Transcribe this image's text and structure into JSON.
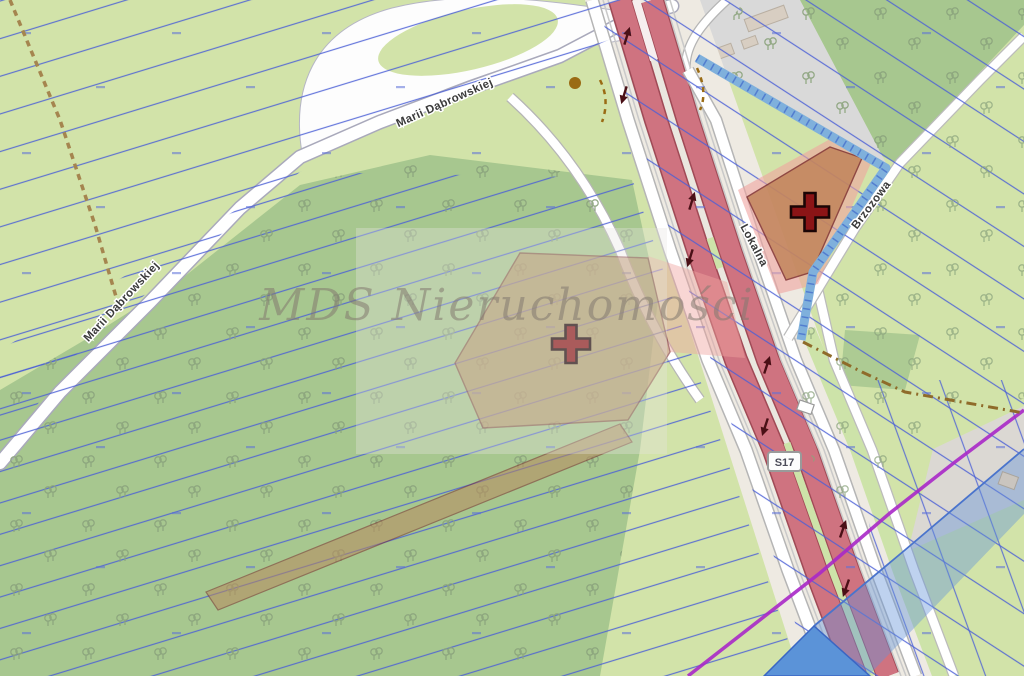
{
  "map": {
    "kind": "cadastral-property-map",
    "watermark_text": "MDS Nieruchomości",
    "labels": {
      "road_upper": "Marii Dąbrowskiej",
      "road_lower": "Marii Dąbrowskiej",
      "service_road": "Lokalna",
      "side_street": "Brzozowa",
      "route_shield": "S17"
    },
    "markers": {
      "count": 2,
      "color": "#8b1416"
    },
    "colors": {
      "field": "#d2e3a9",
      "forest": "#a7c78f",
      "corridor": "#eeeae2",
      "road_fill": "#ffffff",
      "carriageway": "#cf7380",
      "carriageway_casing": "#a04a56",
      "parcel_line": "#4b5fd6",
      "selection_fill": "#b98a5e",
      "selection_halo": "#f0a3a0",
      "stream": "#7fb0dc",
      "water": "#5b93d8",
      "water_zone": "rgba(100,148,216,0.42)",
      "boundary_purple": "#a928c8",
      "gray_area": "#dbd8d3"
    }
  }
}
